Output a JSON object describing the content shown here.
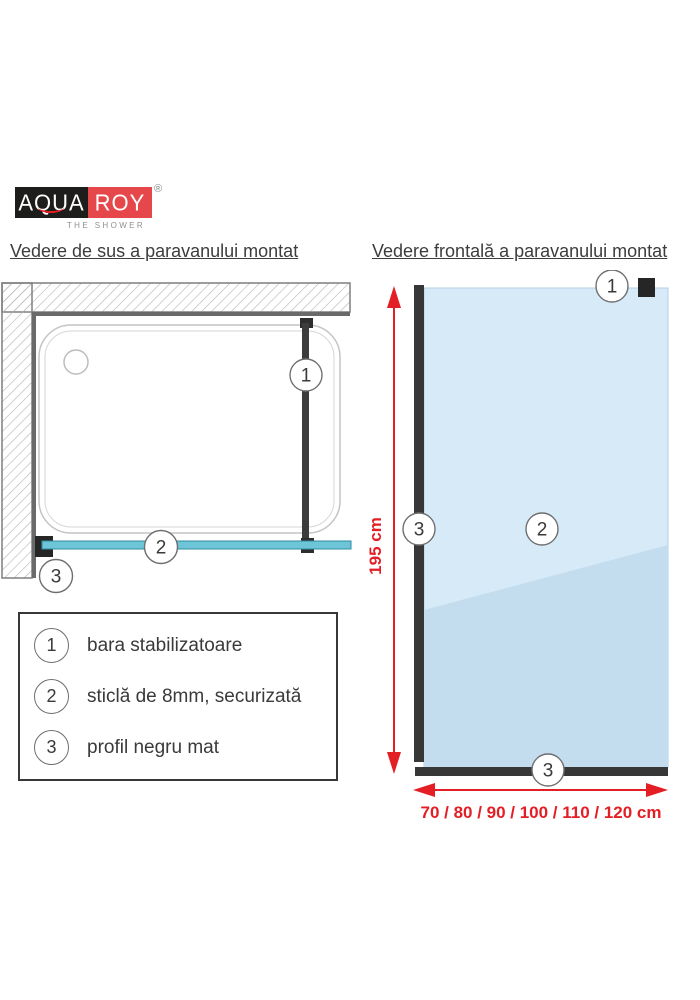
{
  "logo": {
    "name_left": "AQUA",
    "name_right": "ROY",
    "registered": "®",
    "tagline": "THE SHOWER"
  },
  "titles": {
    "top_view": "Vedere de sus a paravanului montat",
    "front_view": "Vedere frontală a paravanului montat"
  },
  "markers": {
    "m1": "1",
    "m2": "2",
    "m3": "3"
  },
  "dimensions": {
    "height_label": "195 cm",
    "width_label": "70 / 80 / 90 / 100 / 110 / 120 cm"
  },
  "legend": {
    "items": [
      {
        "num": "1",
        "label": "bara stabilizatoare"
      },
      {
        "num": "2",
        "label": "sticlă de 8mm, securizată"
      },
      {
        "num": "3",
        "label": "profil negru mat"
      }
    ]
  },
  "colors": {
    "accent_red": "#e31e24",
    "logo_black": "#1d1d1b",
    "logo_red": "#e6474b",
    "glass_blue_light": "#d7eaf8",
    "glass_blue_dark": "#c3ddef",
    "glass_teal_topview": "#6ec5d7",
    "profile_dark": "#373737",
    "wall_hatch_gray": "#b3b3b3"
  }
}
